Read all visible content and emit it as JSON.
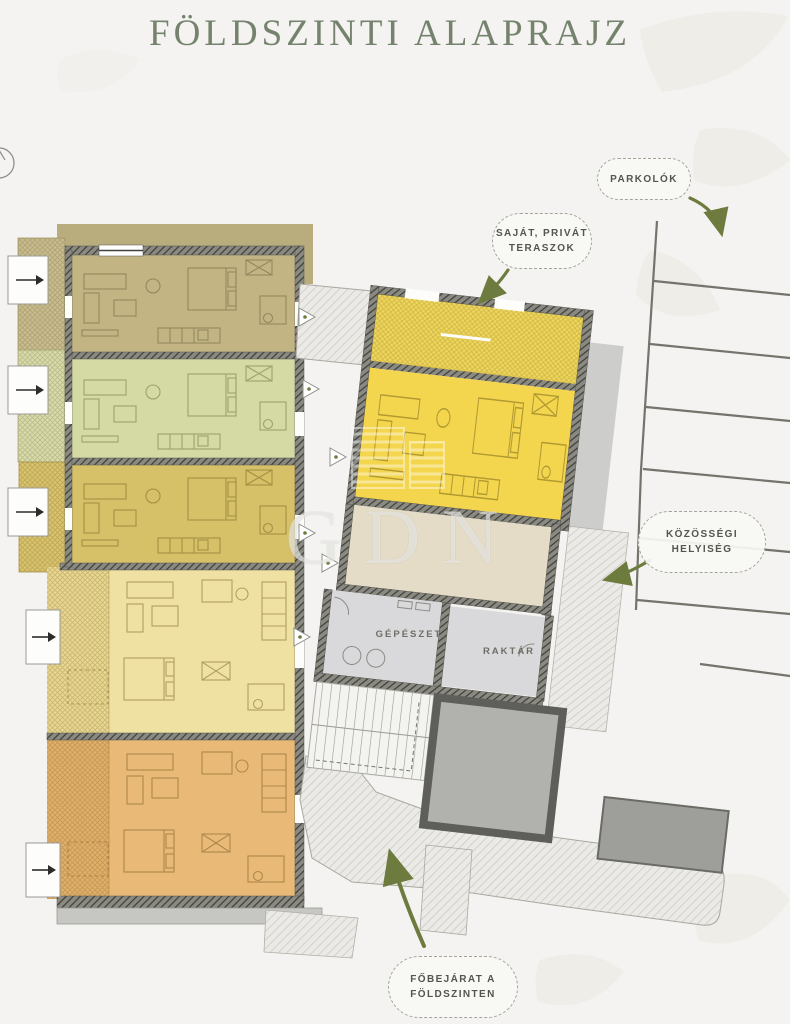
{
  "title": "FÖLDSZINTI ALAPRAJZ",
  "callouts": {
    "parking": "PARKOLÓK",
    "terraces_line1": "SAJÁT, PRIVÁT",
    "terraces_line2": "TERASZOK",
    "community_line1": "KÖZÖSSÉGI",
    "community_line2": "HELYISÉG",
    "entrance_line1": "FŐBEJÁRAT A",
    "entrance_line2": "FÖLDSZINTEN"
  },
  "rooms": {
    "mechanical": "GÉPÉSZET",
    "storage": "RAKTÁR"
  },
  "watermark": "GDN",
  "palette": {
    "background": "#f4f3f1",
    "title_color": "#75836e",
    "annotation_arrow_green": "#6d7b3e",
    "wall_hatch": "#3e3e39",
    "apartments": [
      {
        "name": "apartment-1-tan",
        "fill": "#c2b483"
      },
      {
        "name": "apartment-2-green",
        "fill": "#d5daa4"
      },
      {
        "name": "apartment-3-gold",
        "fill": "#d6c068"
      },
      {
        "name": "apartment-4-pale-yellow",
        "fill": "#efe1a2"
      },
      {
        "name": "apartment-5-orange",
        "fill": "#e8b977"
      },
      {
        "name": "apartment-6-yellow-right",
        "fill": "#f3d54e"
      }
    ],
    "community_room_fill": "#e4dcc6",
    "service_room_fill": "#d9d9db",
    "core_block_fill": "#b1b1ae",
    "path_fill": "#ebeae6"
  }
}
